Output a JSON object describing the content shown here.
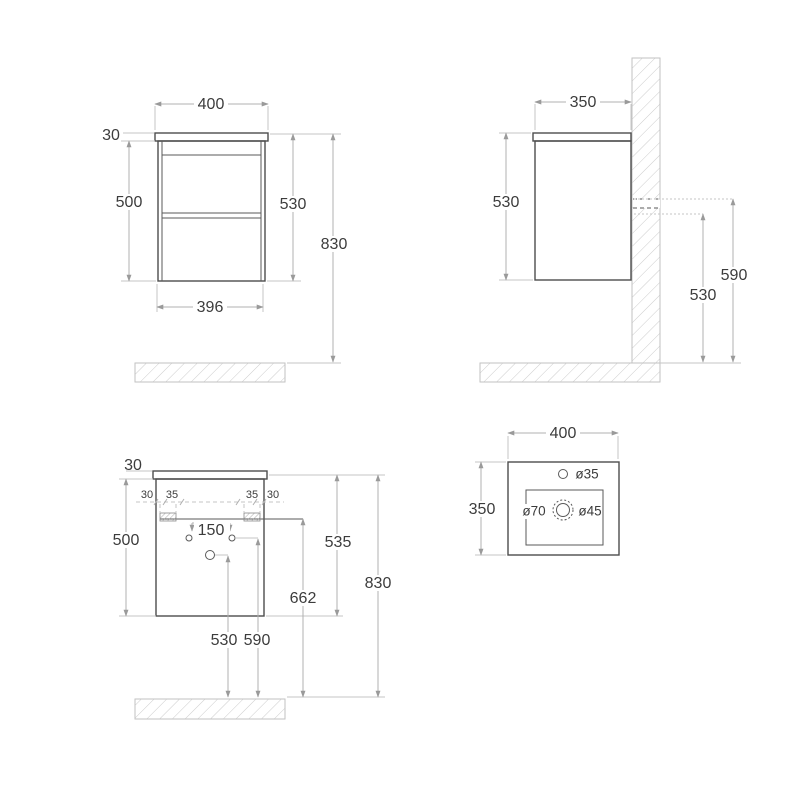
{
  "drawing": {
    "front_view": {
      "width_top": "400",
      "top_thickness": "30",
      "carcass_height": "500",
      "cabinet_height": "530",
      "total_height": "830",
      "width_bottom": "396"
    },
    "side_view": {
      "depth": "350",
      "cabinet_height": "530",
      "upper_fixing_height": "590",
      "lower_fixing_height": "530"
    },
    "back_view": {
      "top_thickness": "30",
      "left_edge_offset": "30",
      "left_bracket_width": "35",
      "right_bracket_width": "35",
      "right_edge_offset": "30",
      "carcass_height": "500",
      "hole_spacing": "150",
      "unit_height": "535",
      "bracket_height": "662",
      "total_height": "830",
      "drain_hole_height": "530",
      "supply_hole_height": "590"
    },
    "basin_view": {
      "width": "400",
      "depth": "350",
      "faucet_hole_diameter": "ø35",
      "overflow_diameter": "ø70",
      "drain_diameter": "ø45"
    }
  },
  "colors": {
    "outline": "#4d4d4d",
    "dimension_line": "#b0b0b0",
    "hatch": "#cccccc",
    "text": "#3c3c3c",
    "background": "#ffffff"
  }
}
